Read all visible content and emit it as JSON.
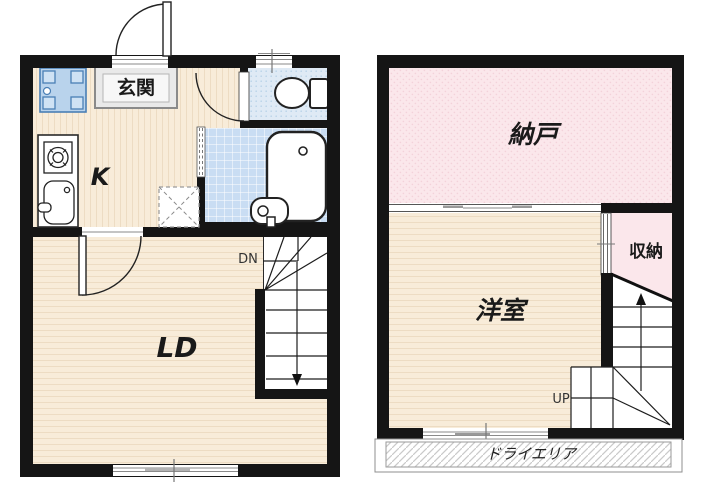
{
  "floor1": {
    "entrance_label": "玄関",
    "kitchen_label": "K",
    "living_dining_label": "LD",
    "stairs_direction_label": "DN"
  },
  "floor2": {
    "storage_room_label": "納戸",
    "western_room_label": "洋室",
    "closet_label": "収納",
    "stairs_direction_label": "UP",
    "dry_area_label": "ドライエリア"
  },
  "colors": {
    "wall": "#151515",
    "wood_floor": "#f8ecd9",
    "wood_floor_stripe": "#eddcc3",
    "pink_floor": "#fbe7eb",
    "pink_floor_dot": "#f3d2da",
    "toilet_floor": "#dfeaf5",
    "toilet_floor_dot": "#b9d3e8",
    "bath_floor": "#c9ddf3",
    "table_fill": "#b9d3ec",
    "table_stroke": "#4a7fb5",
    "fixture_stroke": "#222222",
    "window_line": "#8a8a8a",
    "hatch_line": "#c9c9c9"
  }
}
